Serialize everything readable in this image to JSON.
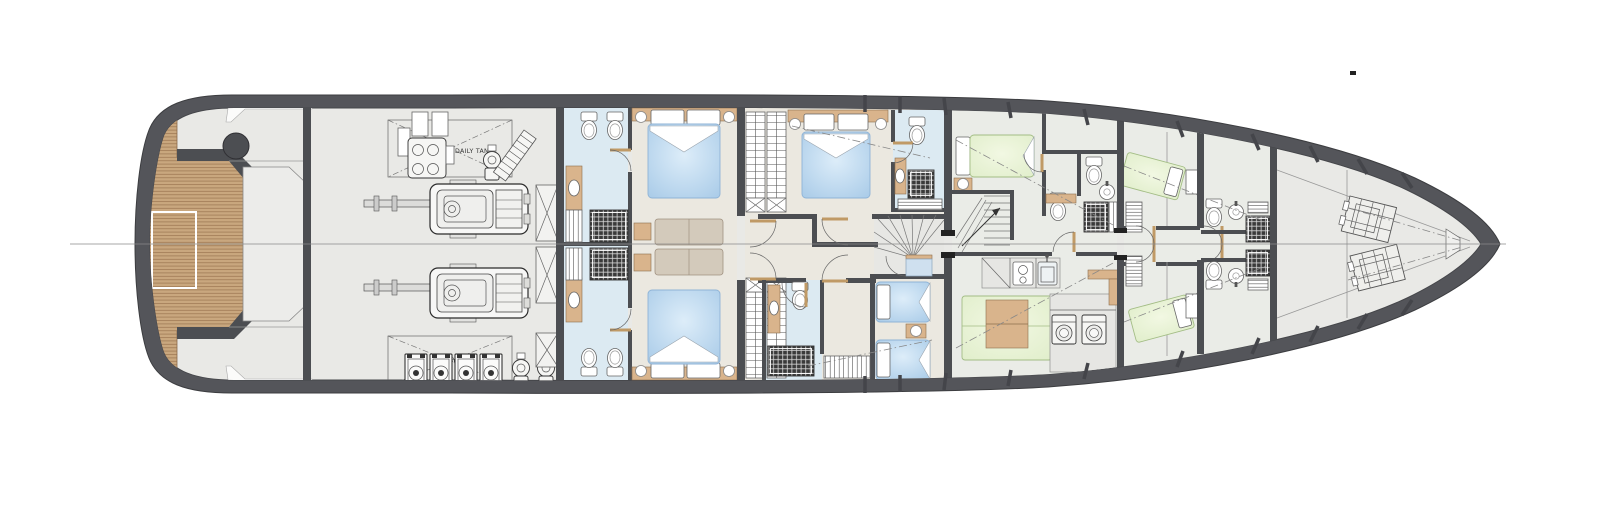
{
  "labels": {
    "daily_tank": "DAILY TANK"
  },
  "colors": {
    "hull": "#54555a",
    "interior": "#e9e9e6",
    "wall": "#4c4e52",
    "cabin": "#ebe8e0",
    "bath": "#dceaf2",
    "crew": "#eaece7",
    "bedblue1": "#ddedf9",
    "bedblue2": "#a6c9e7",
    "bedgreen1": "#f2f8e3",
    "bedgreen2": "#dfedc9",
    "sofa": "#d3cabb",
    "wood": "#d9b48c",
    "teak": "#c9a77e",
    "teakline": "#9a7450",
    "shower": "#3a3a3a",
    "showerline": "#d8d8d8",
    "door": "#c09a66",
    "centerline": "#8a8a8a",
    "counter": "#e6e6e3",
    "text": "#333333"
  }
}
